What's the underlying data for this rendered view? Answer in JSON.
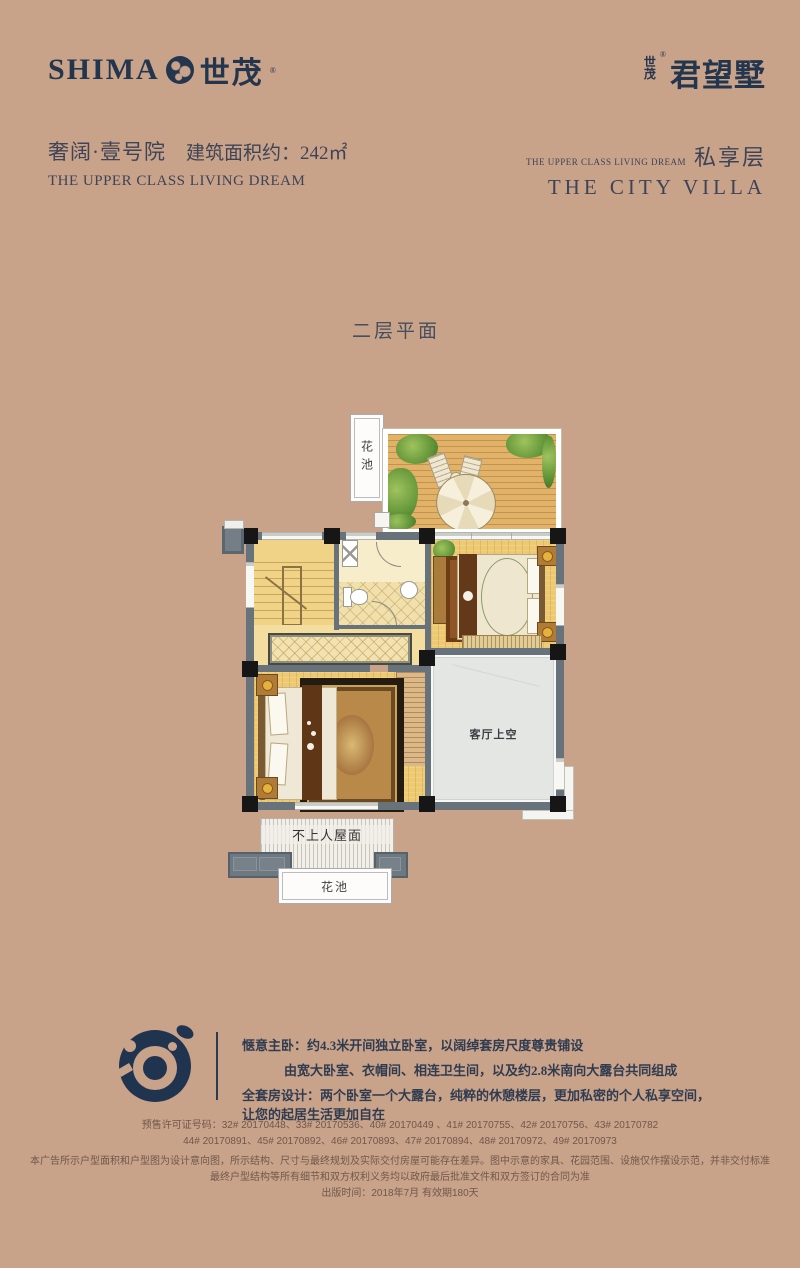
{
  "brand_left": {
    "latin": "SHIMA",
    "cn": "世茂",
    "reg": "®"
  },
  "brand_right": {
    "stack_top": "世",
    "stack_bottom": "茂",
    "reg": "®",
    "name": "君望墅"
  },
  "header_left": {
    "cn_title": "奢阔·壹号院",
    "area": "建筑面积约：242㎡",
    "en": "THE UPPER CLASS LIVING DREAM"
  },
  "header_right": {
    "en_small": "THE UPPER CLASS LIVING DREAM",
    "cn": "私享层",
    "en_big": "THE CITY VILLA"
  },
  "plan": {
    "title": "二层平面",
    "labels": {
      "flower_pool": "花池",
      "living_void": "客厅上空",
      "roof": "不上人屋面",
      "down": "下"
    }
  },
  "description": {
    "l1_label": "惬意主卧：",
    "l1_text": "约4.3米开间独立卧室，以阔绰套房尺度尊贵铺设",
    "l2_text": "由宽大卧室、衣帽间、相连卫生间，以及约2.8米南向大露台共同组成",
    "l3_label": "全套房设计：",
    "l3_text": "两个卧室一个大露台，纯粹的休憩楼层，更加私密的个人私享空间，让您的起居生活更加自在"
  },
  "legal": {
    "permits1": "预售许可证号码：32# 20170448、33# 20170536、40# 20170449 、41# 20170755、42# 20170756、43# 20170782",
    "permits2": "44# 20170891、45# 20170892、46# 20170893、47# 20170894、48# 20170972、49# 20170973",
    "disclaimer1": "本广告所示户型面积和户型图为设计意向图，所示结构、尺寸与最终规划及实际交付房屋可能存在差异。图中示意的家具、花园范围、设施仅作摆设示范，并非交付标准",
    "disclaimer2": "最终户型结构等所有细节和双方权利义务均以政府最后批准文件和双方签订的合同为准",
    "publish": "出版时间：2018年7月  有效期180天"
  },
  "colors": {
    "background": "#c9a28a",
    "brand_navy": "#24364e",
    "wall_gray": "#68727a",
    "floor_yellow": "#edc972",
    "deck_wood": "#e2b269",
    "void_gray": "#e4e6e3",
    "legal_brown": "#6f584b"
  }
}
